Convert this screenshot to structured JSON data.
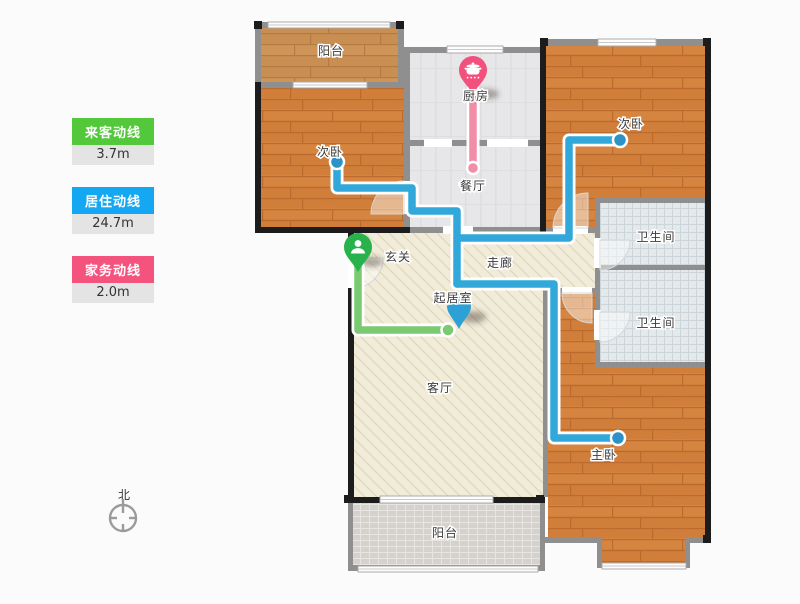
{
  "legend": {
    "items": [
      {
        "label": "来客动线",
        "value": "3.7m",
        "color": "#52c83a"
      },
      {
        "label": "居住动线",
        "value": "24.7m",
        "color": "#15a8f2"
      },
      {
        "label": "家务动线",
        "value": "2.0m",
        "color": "#f4537d"
      }
    ]
  },
  "routes": {
    "visitor": {
      "color": "#79ca70",
      "pin": "#28b24c"
    },
    "living": {
      "color": "#31a7da",
      "pin": "#2da0d6",
      "dot": "#2d92c6"
    },
    "house": {
      "color": "#f28ca7",
      "pin": "#f2507d"
    }
  },
  "rooms": {
    "balcony_top": "阳台",
    "bedroom_left": "次卧",
    "kitchen": "厨房",
    "dining": "餐厅",
    "bedroom_right": "次卧",
    "bath_top": "卫生间",
    "bath_bottom": "卫生间",
    "entry": "玄关",
    "corridor": "走廊",
    "living_point": "起居室",
    "living": "客厅",
    "master": "主卧",
    "balcony_bottom": "阳台"
  },
  "compass": {
    "north": "北"
  }
}
